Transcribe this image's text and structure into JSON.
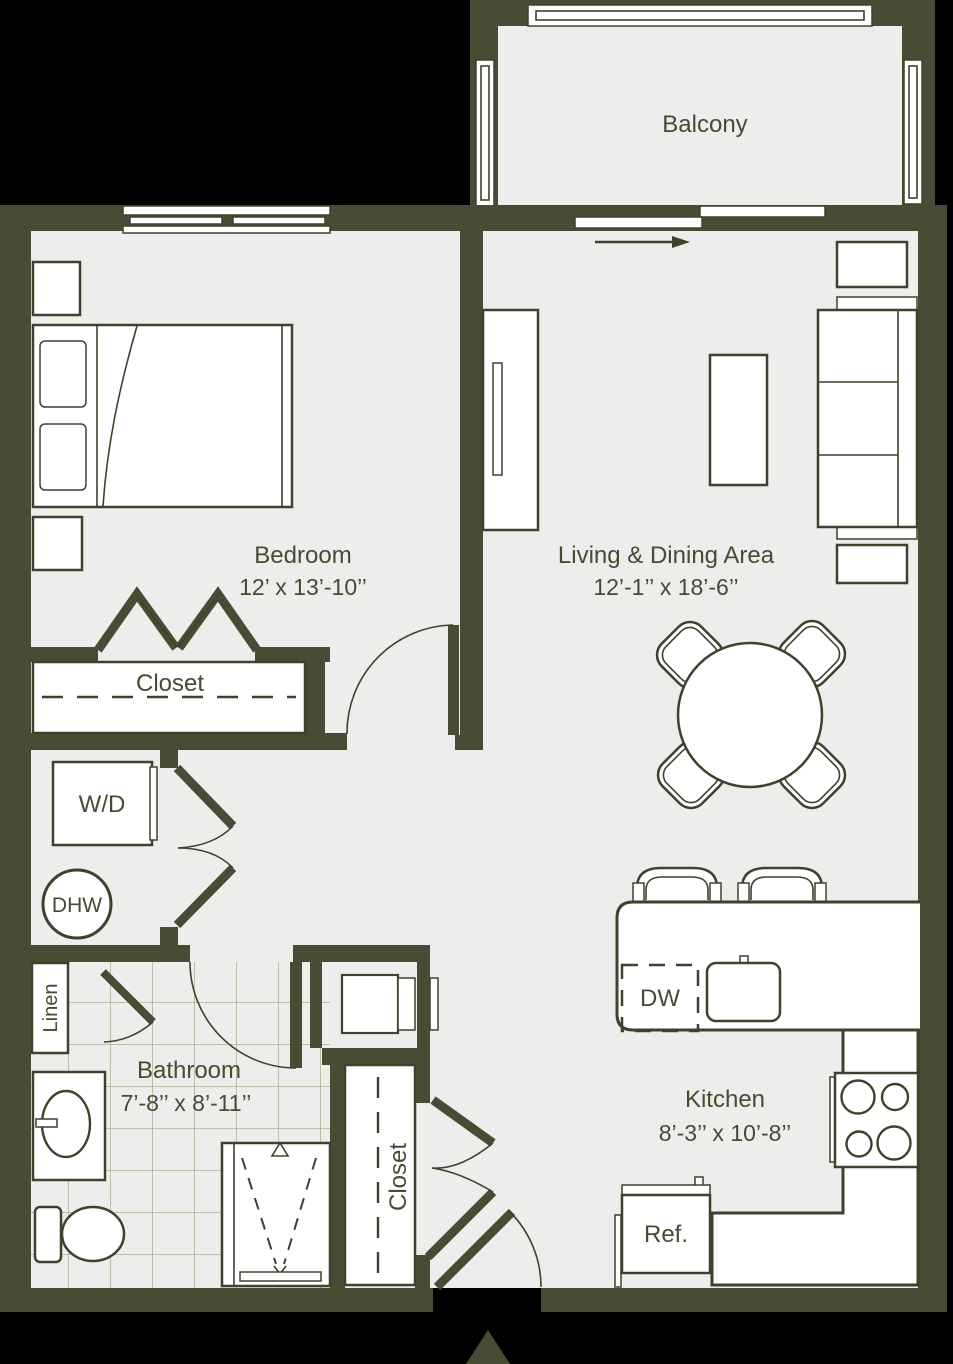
{
  "colors": {
    "wall": "#484c35",
    "floor": "#ededeb",
    "line": "#3e422c",
    "ink": "#474b33",
    "tile": "#abae94",
    "background": "#000000",
    "white": "#ffffff"
  },
  "balcony": {
    "label": "Balcony"
  },
  "bedroom": {
    "label": "Bedroom",
    "dims": "12’ x 13’-10’’"
  },
  "living": {
    "label": "Living & Dining Area",
    "dims": "12’-1’’ x 18’-6’’"
  },
  "bathroom": {
    "label": "Bathroom",
    "dims": "7’-8’’ x 8’-11’’"
  },
  "kitchen": {
    "label": "Kitchen",
    "dims": "8’-3’’ x 10’-8’’"
  },
  "closets": {
    "bedroom_closet": "Closet",
    "entry_closet": "Closet",
    "linen": "Linen"
  },
  "appliances": {
    "washer_dryer": "W/D",
    "water_heater": "DHW",
    "dishwasher": "DW",
    "refrigerator": "Ref."
  }
}
